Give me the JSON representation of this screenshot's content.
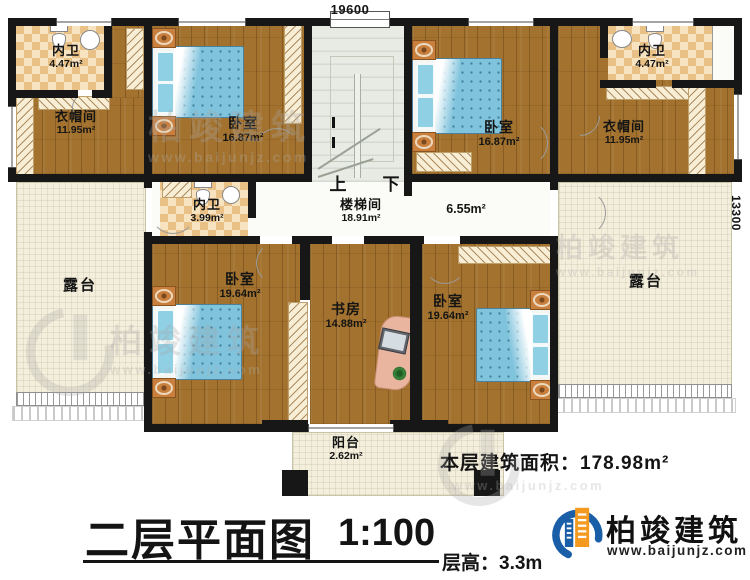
{
  "dimensions": {
    "top": "19600",
    "right": "13300"
  },
  "rooms": {
    "bath_tl": {
      "name": "内卫",
      "area": "4.47m²"
    },
    "cloak_tl": {
      "name": "衣帽间",
      "area": "11.95m²"
    },
    "bed_tl": {
      "name": "卧室",
      "area": "16.87m²"
    },
    "stairwell": {
      "name": "楼梯间",
      "area": "18.91m²",
      "up": "上",
      "down": "下"
    },
    "bed_tr": {
      "name": "卧室",
      "area": "16.87m²"
    },
    "bath_tr": {
      "name": "内卫",
      "area": "4.47m²"
    },
    "cloak_tr": {
      "name": "衣帽间",
      "area": "11.95m²"
    },
    "bath_mid": {
      "name": "内卫",
      "area": "3.99m²"
    },
    "corridor": {
      "area": "6.55m²"
    },
    "terrace_left": {
      "name": "露台"
    },
    "terrace_right": {
      "name": "露台"
    },
    "bed_bl": {
      "name": "卧室",
      "area": "19.64m²"
    },
    "study": {
      "name": "书房",
      "area": "14.88m²"
    },
    "bed_br": {
      "name": "卧室",
      "area": "19.64m²"
    },
    "balcony": {
      "name": "阳台",
      "area": "2.62m²"
    }
  },
  "footer": {
    "area_label": "本层建筑面积：",
    "area_value": "178.98m²",
    "title": "二层平面图",
    "scale": "1:100",
    "floor_height_label": "层高：",
    "floor_height_value": "3.3m"
  },
  "brand": {
    "name": "柏竣建筑",
    "url": "www.baijunjz.com"
  },
  "watermark": {
    "name": "柏竣建筑",
    "url": "www.baijunjz.com"
  },
  "colors": {
    "wall": "#171717",
    "wood": "#a3722e",
    "tile": "#eecf9a",
    "terrace": "#f3efdc",
    "stair": "#e8ebe3",
    "bed_blue": "#7fc3dc",
    "logo_blue": "#1a5ea8",
    "logo_orange": "#f59a20"
  }
}
